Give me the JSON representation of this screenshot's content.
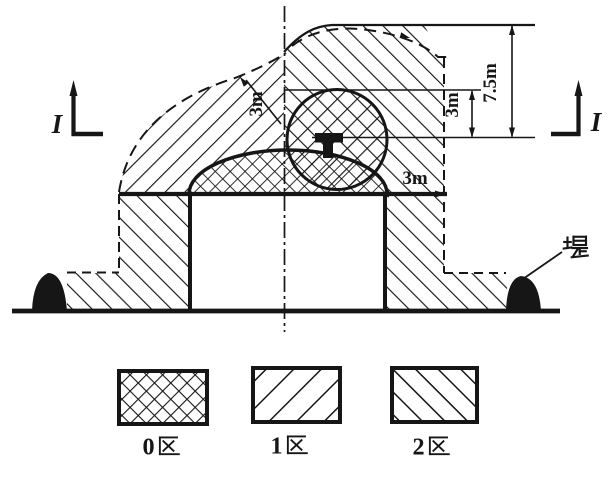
{
  "diagram": {
    "title_hint": "tank-hazardous-area-classification-section",
    "dimensions": {
      "roof_clearance": "3m",
      "vent_radius": "3m",
      "shell_clearance": "3m",
      "total_height": "7.5m"
    },
    "section_marker": "I",
    "dike_label": "堤",
    "legend": {
      "items": [
        {
          "label": "0区",
          "pattern": "crosshatch"
        },
        {
          "label": "1区",
          "pattern": "diagonal-rising"
        },
        {
          "label": "2区",
          "pattern": "diagonal-falling"
        }
      ]
    },
    "colors": {
      "ink": "#161616",
      "background": "#ffffff"
    }
  }
}
